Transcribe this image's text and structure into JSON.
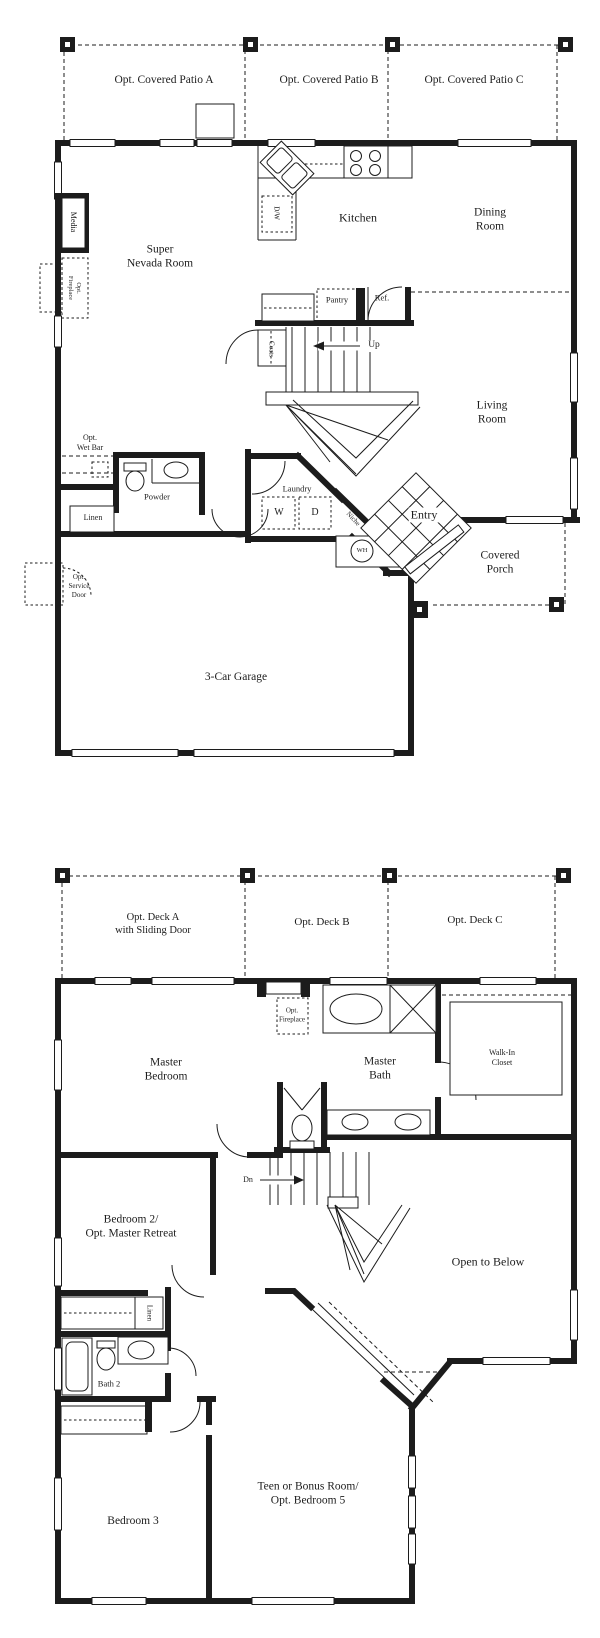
{
  "page": {
    "background": "#ffffff",
    "ink_color": "#1c1c1c",
    "kind": "two-story house floor plan"
  },
  "floor1": {
    "labels": {
      "patio_a": "Opt. Covered Patio A",
      "patio_b": "Opt. Covered Patio B",
      "patio_c": "Opt. Covered Patio C",
      "super_nevada": {
        "l1": "Super",
        "l2": "Nevada Room"
      },
      "media": "Media",
      "opt_fireplace": {
        "l1": "Opt.",
        "l2": "Fireplace"
      },
      "kitchen": "Kitchen",
      "dining": {
        "l1": "Dining",
        "l2": "Room"
      },
      "dw": "D/W",
      "pantry": "Pantry",
      "ref": "Ref.",
      "up": "Up",
      "coats": "Coats",
      "living": {
        "l1": "Living",
        "l2": "Room"
      },
      "wet_bar": {
        "l1": "Opt.",
        "l2": "Wet Bar"
      },
      "powder": "Powder",
      "linen": "Linen",
      "laundry": "Laundry",
      "washer": "W",
      "dryer": "D",
      "niche": "Niche",
      "water_heater": "WH",
      "entry": "Entry",
      "covered_porch": {
        "l1": "Covered",
        "l2": "Porch"
      },
      "service_door": {
        "l1": "Opt.",
        "l2": "Service",
        "l3": "Door"
      },
      "garage": "3-Car Garage"
    }
  },
  "floor2": {
    "labels": {
      "deck_a": {
        "l1": "Opt. Deck A",
        "l2": "with Sliding Door"
      },
      "deck_b": "Opt. Deck B",
      "deck_c": "Opt. Deck C",
      "master_bedroom": {
        "l1": "Master",
        "l2": "Bedroom"
      },
      "opt_fireplace": {
        "l1": "Opt.",
        "l2": "Fireplace"
      },
      "master_bath": {
        "l1": "Master",
        "l2": "Bath"
      },
      "walk_in_closet": {
        "l1": "Walk-In",
        "l2": "Closet"
      },
      "dn": "Dn",
      "bedroom2": {
        "l1": "Bedroom 2/",
        "l2": "Opt. Master Retreat"
      },
      "open_to_below": "Open to Below",
      "linen": "Linen",
      "bath2": "Bath 2",
      "bedroom3": "Bedroom 3",
      "teen": {
        "l1": "Teen or Bonus Room/",
        "l2": "Opt. Bedroom 5"
      }
    }
  }
}
